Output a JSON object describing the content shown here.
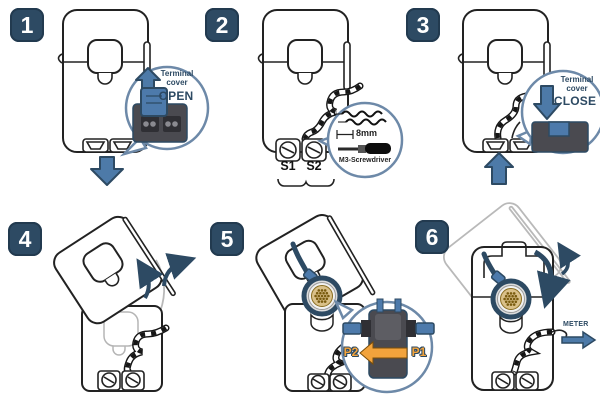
{
  "steps": [
    {
      "number": "1",
      "callout": {
        "label": "Terminal cover",
        "action": "OPEN"
      }
    },
    {
      "number": "2",
      "terminals": {
        "left": "S1",
        "right": "S2"
      },
      "callout": {
        "strip_length": "8mm",
        "tool": "M3-Screwdriver"
      }
    },
    {
      "number": "3",
      "callout": {
        "label": "Terminal cover",
        "action": "CLOSE"
      }
    },
    {
      "number": "4"
    },
    {
      "number": "5",
      "callout": {
        "left_label": "P2",
        "right_label": "P1"
      }
    },
    {
      "number": "6",
      "meter_label": "METER"
    }
  ],
  "colors": {
    "step_badge": "#2d4a63",
    "arrow_blue": "#4d7aa8",
    "callout_border": "#6d89a8",
    "terminal_block_gray": "#4a4a50",
    "terminal_cover_blue": "#4d7aab",
    "direction_orange": "#f2a33c",
    "conductor_strands": "#d9c089",
    "line_art": "#222222"
  }
}
